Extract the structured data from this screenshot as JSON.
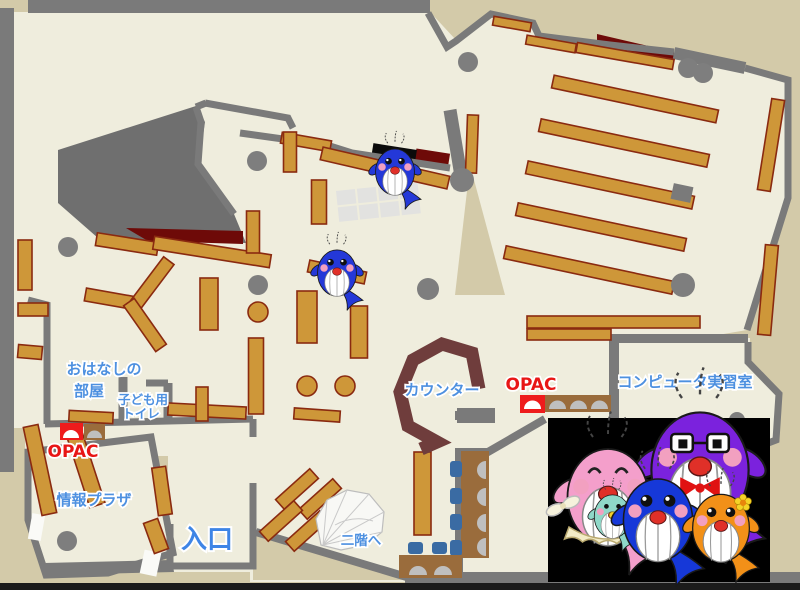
{
  "labels": {
    "storytime_room": {
      "line1": "おはなしの",
      "line2": "部屋"
    },
    "kids_toilet": {
      "line1": "子ども用",
      "line2": "トイレ"
    },
    "opac_left": "OPAC",
    "opac_right": "OPAC",
    "info_plaza": "情報プラザ",
    "entrance": "入口",
    "counter": "カウンター",
    "computer_room": "コンピュータ実習室",
    "to_second_floor": "二階へ"
  },
  "colors": {
    "outside": "#D3CAA9",
    "floor": "#EFEDDD",
    "wall": "#7A7A7A",
    "shelf": "#CE9739",
    "shelf_border": "#8A2A10",
    "counter": "#6F3D3C",
    "storage_red": "#6E0A08",
    "label_blue": "#4D90E0",
    "entrance_blue": "#3E85E6",
    "opac_red": "#E81616",
    "chair_blue": "#3A6BA3",
    "desk_brown": "#9A6C3C",
    "photo_background": "#000000"
  },
  "mascots": {
    "family": [
      "pink-mother-whale",
      "purple-father-whale",
      "blue-child-whale",
      "orange-child-whale",
      "teal-baby-whale"
    ],
    "floor_sprites": [
      "blue-whale-sprite-upper",
      "blue-whale-sprite-lower"
    ]
  }
}
